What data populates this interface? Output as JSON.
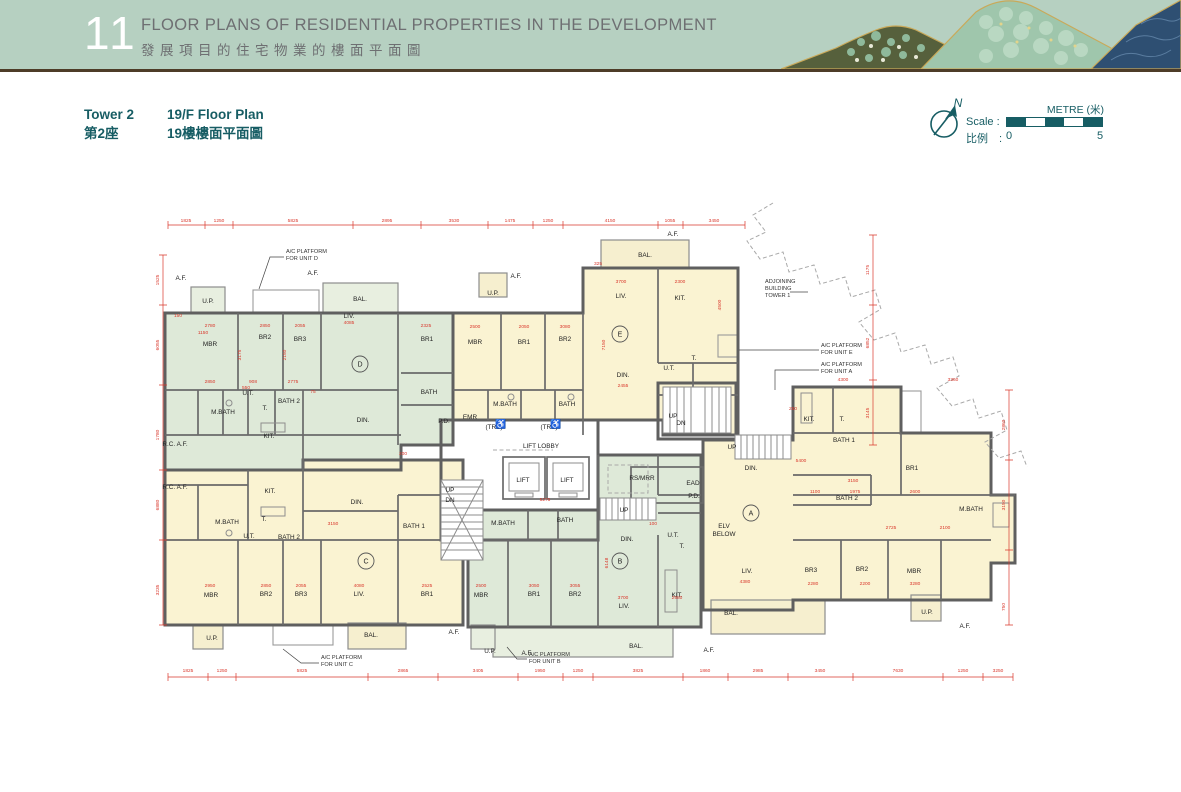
{
  "header": {
    "number": "11",
    "title_en": "FLOOR PLANS OF RESIDENTIAL PROPERTIES IN THE DEVELOPMENT",
    "title_zh": "發展項目的住宅物業的樓面平面圖"
  },
  "subheader": {
    "tower_en": "Tower 2",
    "tower_zh": "第2座",
    "plan_en": "19/F Floor Plan",
    "plan_zh": "19樓樓面平面圖"
  },
  "compass": {
    "north": "N"
  },
  "scale": {
    "label_en": "Scale :",
    "label_zh": "比例　:",
    "metre": "METRE (米)",
    "start": "0",
    "end": "5"
  },
  "colors": {
    "header_green": "#b6d0c1",
    "teal": "#175d64",
    "unit_cream": "#faf3d2",
    "unit_green": "#dee9d8",
    "dimension_red": "#d9372b",
    "wall_grey": "#5f5f5f",
    "rule_brown": "#4d3c28"
  },
  "plan": {
    "unit_circles": [
      {
        "t": "D",
        "x": 207,
        "y": 169
      },
      {
        "t": "E",
        "x": 467,
        "y": 139
      },
      {
        "t": "C",
        "x": 213,
        "y": 366
      },
      {
        "t": "B",
        "x": 467,
        "y": 366
      },
      {
        "t": "A",
        "x": 598,
        "y": 318
      }
    ],
    "rooms": [
      {
        "t": "MBR",
        "x": 57,
        "y": 151
      },
      {
        "t": "BR2",
        "x": 112,
        "y": 144
      },
      {
        "t": "BR3",
        "x": 147,
        "y": 146
      },
      {
        "t": "LIV.",
        "x": 196,
        "y": 123
      },
      {
        "t": "BAL.",
        "x": 207,
        "y": 106
      },
      {
        "t": "U.P.",
        "x": 55,
        "y": 108
      },
      {
        "t": "M.BATH",
        "x": 70,
        "y": 219
      },
      {
        "t": "U.T.",
        "x": 95,
        "y": 200
      },
      {
        "t": "T.",
        "x": 112,
        "y": 215
      },
      {
        "t": "BATH 2",
        "x": 136,
        "y": 208
      },
      {
        "t": "KIT.",
        "x": 116,
        "y": 243
      },
      {
        "t": "DIN.",
        "x": 210,
        "y": 227
      },
      {
        "t": "BR1",
        "x": 274,
        "y": 146
      },
      {
        "t": "BATH",
        "x": 276,
        "y": 199
      },
      {
        "t": "P.D.",
        "x": 291,
        "y": 228
      },
      {
        "t": "MBR",
        "x": 322,
        "y": 149
      },
      {
        "t": "BR1",
        "x": 371,
        "y": 149
      },
      {
        "t": "BR2",
        "x": 412,
        "y": 146
      },
      {
        "t": "LIV.",
        "x": 468,
        "y": 103
      },
      {
        "t": "KIT.",
        "x": 527,
        "y": 105
      },
      {
        "t": "DIN.",
        "x": 470,
        "y": 182
      },
      {
        "t": "BAL.",
        "x": 492,
        "y": 62
      },
      {
        "t": "U.P.",
        "x": 340,
        "y": 100
      },
      {
        "t": "M.BATH",
        "x": 352,
        "y": 211
      },
      {
        "t": "BATH",
        "x": 414,
        "y": 211
      },
      {
        "t": "U.T.",
        "x": 516,
        "y": 175
      },
      {
        "t": "T.",
        "x": 541,
        "y": 165
      },
      {
        "t": "EMR",
        "x": 317,
        "y": 224
      },
      {
        "t": "LIFT LOBBY",
        "x": 388,
        "y": 253
      },
      {
        "t": "LIFT",
        "x": 370,
        "y": 287
      },
      {
        "t": "LIFT",
        "x": 414,
        "y": 287
      },
      {
        "t": "(TRS)",
        "x": 341,
        "y": 234
      },
      {
        "t": "(TRS)",
        "x": 396,
        "y": 234
      },
      {
        "t": "M.BATH",
        "x": 350,
        "y": 330
      },
      {
        "t": "BATH",
        "x": 412,
        "y": 327
      },
      {
        "t": "UP",
        "x": 297,
        "y": 297
      },
      {
        "t": "DN",
        "x": 297,
        "y": 307
      },
      {
        "t": "RS/MRR",
        "x": 489,
        "y": 285
      },
      {
        "t": "EAD",
        "x": 540,
        "y": 290
      },
      {
        "t": "P.D.",
        "x": 541,
        "y": 303
      },
      {
        "t": "UP",
        "x": 471,
        "y": 317
      },
      {
        "t": "ELV",
        "x": 571,
        "y": 333
      },
      {
        "t": "BELOW",
        "x": 571,
        "y": 341
      },
      {
        "t": "UP",
        "x": 520,
        "y": 223
      },
      {
        "t": "DN",
        "x": 528,
        "y": 230
      },
      {
        "t": "DIN.",
        "x": 474,
        "y": 346
      },
      {
        "t": "T.",
        "x": 529,
        "y": 353
      },
      {
        "t": "U.T.",
        "x": 520,
        "y": 342
      },
      {
        "t": "KIT.",
        "x": 524,
        "y": 402
      },
      {
        "t": "LIV.",
        "x": 471,
        "y": 413
      },
      {
        "t": "MBR",
        "x": 328,
        "y": 402
      },
      {
        "t": "BR1",
        "x": 381,
        "y": 401
      },
      {
        "t": "BR2",
        "x": 422,
        "y": 401
      },
      {
        "t": "BAL.",
        "x": 483,
        "y": 453
      },
      {
        "t": "U.P.",
        "x": 337,
        "y": 458
      },
      {
        "t": "KIT.",
        "x": 117,
        "y": 298
      },
      {
        "t": "DIN.",
        "x": 204,
        "y": 309
      },
      {
        "t": "M.BATH",
        "x": 74,
        "y": 329
      },
      {
        "t": "U.T.",
        "x": 96,
        "y": 343
      },
      {
        "t": "T.",
        "x": 111,
        "y": 326
      },
      {
        "t": "BATH 2",
        "x": 136,
        "y": 344
      },
      {
        "t": "BATH 1",
        "x": 261,
        "y": 333
      },
      {
        "t": "MBR",
        "x": 58,
        "y": 402
      },
      {
        "t": "BR2",
        "x": 113,
        "y": 401
      },
      {
        "t": "BR3",
        "x": 148,
        "y": 401
      },
      {
        "t": "LIV.",
        "x": 206,
        "y": 401
      },
      {
        "t": "BR1",
        "x": 274,
        "y": 401
      },
      {
        "t": "BAL.",
        "x": 218,
        "y": 442
      },
      {
        "t": "U.P.",
        "x": 59,
        "y": 445
      },
      {
        "t": "DIN.",
        "x": 598,
        "y": 275
      },
      {
        "t": "LIV.",
        "x": 594,
        "y": 378
      },
      {
        "t": "BAL.",
        "x": 578,
        "y": 420
      },
      {
        "t": "BR3",
        "x": 658,
        "y": 377
      },
      {
        "t": "BR2",
        "x": 709,
        "y": 376
      },
      {
        "t": "MBR",
        "x": 761,
        "y": 378
      },
      {
        "t": "M.BATH",
        "x": 818,
        "y": 316
      },
      {
        "t": "BR1",
        "x": 759,
        "y": 275
      },
      {
        "t": "BATH 1",
        "x": 691,
        "y": 247
      },
      {
        "t": "BATH 2",
        "x": 694,
        "y": 305
      },
      {
        "t": "T.",
        "x": 689,
        "y": 226
      },
      {
        "t": "KIT.",
        "x": 656,
        "y": 226
      },
      {
        "t": "U.P.",
        "x": 774,
        "y": 419
      },
      {
        "t": "UP",
        "x": 579,
        "y": 254
      },
      {
        "t": "A.F.",
        "x": 28,
        "y": 85
      },
      {
        "t": "A.F.",
        "x": 160,
        "y": 80
      },
      {
        "t": "A.F.",
        "x": 363,
        "y": 83
      },
      {
        "t": "A.F.",
        "x": 520,
        "y": 41
      },
      {
        "t": "A.F.",
        "x": 301,
        "y": 439
      },
      {
        "t": "A.F.",
        "x": 374,
        "y": 460
      },
      {
        "t": "A.F.",
        "x": 556,
        "y": 457
      },
      {
        "t": "A.F.",
        "x": 812,
        "y": 433
      },
      {
        "t": "R.C. A.F.",
        "x": 22,
        "y": 251
      },
      {
        "t": "R.C. A.F.",
        "x": 22,
        "y": 294
      }
    ],
    "annotations": [
      {
        "t": "A/C PLATFORM",
        "x": 133,
        "y": 58
      },
      {
        "t": "FOR UNIT D",
        "x": 133,
        "y": 65
      },
      {
        "t": "A/C PLATFORM",
        "x": 668,
        "y": 152
      },
      {
        "t": "FOR UNIT E",
        "x": 668,
        "y": 159
      },
      {
        "t": "A/C PLATFORM",
        "x": 668,
        "y": 171
      },
      {
        "t": "FOR UNIT A",
        "x": 668,
        "y": 178
      },
      {
        "t": "ADJOINING",
        "x": 612,
        "y": 88
      },
      {
        "t": "BUILDING",
        "x": 612,
        "y": 95
      },
      {
        "t": "TOWER 1",
        "x": 612,
        "y": 102
      },
      {
        "t": "A/C PLATFORM",
        "x": 168,
        "y": 464
      },
      {
        "t": "FOR UNIT C",
        "x": 168,
        "y": 471
      },
      {
        "t": "A/C PLATFORM",
        "x": 376,
        "y": 461
      },
      {
        "t": "FOR UNIT B",
        "x": 376,
        "y": 468
      }
    ],
    "icons": [
      {
        "t": "♿",
        "x": 348,
        "y": 232,
        "n": "wheelchair-icon"
      },
      {
        "t": "♿",
        "x": 403,
        "y": 232,
        "n": "wheelchair-icon"
      }
    ],
    "dims": [
      {
        "t": "1825",
        "x": 33,
        "y": 27
      },
      {
        "t": "1250",
        "x": 66,
        "y": 27
      },
      {
        "t": "5825",
        "x": 140,
        "y": 27
      },
      {
        "t": "2895",
        "x": 234,
        "y": 27
      },
      {
        "t": "3530",
        "x": 301,
        "y": 27
      },
      {
        "t": "1475",
        "x": 357,
        "y": 27
      },
      {
        "t": "1250",
        "x": 395,
        "y": 27
      },
      {
        "t": "4150",
        "x": 457,
        "y": 27
      },
      {
        "t": "1055",
        "x": 517,
        "y": 27
      },
      {
        "t": "3450",
        "x": 561,
        "y": 27
      },
      {
        "t": "1825",
        "x": 35,
        "y": 477
      },
      {
        "t": "1250",
        "x": 69,
        "y": 477
      },
      {
        "t": "5825",
        "x": 149,
        "y": 477
      },
      {
        "t": "2865",
        "x": 250,
        "y": 477
      },
      {
        "t": "3405",
        "x": 325,
        "y": 477
      },
      {
        "t": "1950",
        "x": 387,
        "y": 477
      },
      {
        "t": "1250",
        "x": 425,
        "y": 477
      },
      {
        "t": "3825",
        "x": 485,
        "y": 477
      },
      {
        "t": "1860",
        "x": 552,
        "y": 477
      },
      {
        "t": "2985",
        "x": 605,
        "y": 477
      },
      {
        "t": "3450",
        "x": 667,
        "y": 477
      },
      {
        "t": "7630",
        "x": 745,
        "y": 477
      },
      {
        "t": "1250",
        "x": 810,
        "y": 477
      },
      {
        "t": "3250",
        "x": 845,
        "y": 477
      },
      {
        "t": "1525",
        "x": 6,
        "y": 85,
        "r": -90
      },
      {
        "t": "6055",
        "x": 6,
        "y": 150,
        "r": -90
      },
      {
        "t": "1780",
        "x": 6,
        "y": 240,
        "r": -90
      },
      {
        "t": "6880",
        "x": 6,
        "y": 310,
        "r": -90
      },
      {
        "t": "3235",
        "x": 6,
        "y": 395,
        "r": -90
      },
      {
        "t": "1175",
        "x": 716,
        "y": 75,
        "r": -90
      },
      {
        "t": "6852",
        "x": 716,
        "y": 148,
        "r": -90
      },
      {
        "t": "3145",
        "x": 716,
        "y": 218,
        "r": -90
      },
      {
        "t": "2860",
        "x": 852,
        "y": 230,
        "r": -90
      },
      {
        "t": "3150",
        "x": 852,
        "y": 310,
        "r": -90
      },
      {
        "t": "750",
        "x": 852,
        "y": 412,
        "r": -90
      },
      {
        "t": "2780",
        "x": 57,
        "y": 132
      },
      {
        "t": "1150",
        "x": 50,
        "y": 139
      },
      {
        "t": "2850",
        "x": 112,
        "y": 132
      },
      {
        "t": "2055",
        "x": 147,
        "y": 132
      },
      {
        "t": "4085",
        "x": 196,
        "y": 129
      },
      {
        "t": "2325",
        "x": 273,
        "y": 132
      },
      {
        "t": "2850",
        "x": 57,
        "y": 188
      },
      {
        "t": "908",
        "x": 100,
        "y": 188
      },
      {
        "t": "2775",
        "x": 140,
        "y": 188
      },
      {
        "t": "550",
        "x": 93,
        "y": 194
      },
      {
        "t": "3175",
        "x": 88,
        "y": 160,
        "r": -90
      },
      {
        "t": "2150",
        "x": 133,
        "y": 160,
        "r": -90
      },
      {
        "t": "2500",
        "x": 322,
        "y": 133
      },
      {
        "t": "2050",
        "x": 371,
        "y": 133
      },
      {
        "t": "3080",
        "x": 412,
        "y": 133
      },
      {
        "t": "3700",
        "x": 468,
        "y": 88
      },
      {
        "t": "2300",
        "x": 527,
        "y": 88
      },
      {
        "t": "7150",
        "x": 452,
        "y": 150,
        "r": -90
      },
      {
        "t": "2455",
        "x": 470,
        "y": 192
      },
      {
        "t": "4500",
        "x": 568,
        "y": 110,
        "r": -90
      },
      {
        "t": "5275",
        "x": 392,
        "y": 306
      },
      {
        "t": "2500",
        "x": 328,
        "y": 392
      },
      {
        "t": "3050",
        "x": 381,
        "y": 392
      },
      {
        "t": "3055",
        "x": 422,
        "y": 392
      },
      {
        "t": "3700",
        "x": 470,
        "y": 404
      },
      {
        "t": "2980",
        "x": 524,
        "y": 404
      },
      {
        "t": "6148",
        "x": 455,
        "y": 368,
        "r": -90
      },
      {
        "t": "2950",
        "x": 57,
        "y": 392
      },
      {
        "t": "2850",
        "x": 113,
        "y": 392
      },
      {
        "t": "2055",
        "x": 148,
        "y": 392
      },
      {
        "t": "4080",
        "x": 206,
        "y": 392
      },
      {
        "t": "2525",
        "x": 274,
        "y": 392
      },
      {
        "t": "3150",
        "x": 180,
        "y": 330
      },
      {
        "t": "5400",
        "x": 648,
        "y": 267
      },
      {
        "t": "3150",
        "x": 700,
        "y": 287
      },
      {
        "t": "1100",
        "x": 662,
        "y": 298
      },
      {
        "t": "1975",
        "x": 702,
        "y": 298
      },
      {
        "t": "2600",
        "x": 762,
        "y": 298
      },
      {
        "t": "2725",
        "x": 738,
        "y": 334
      },
      {
        "t": "2100",
        "x": 792,
        "y": 334
      },
      {
        "t": "3280",
        "x": 762,
        "y": 390
      },
      {
        "t": "2200",
        "x": 712,
        "y": 390
      },
      {
        "t": "2280",
        "x": 660,
        "y": 390
      },
      {
        "t": "4300",
        "x": 690,
        "y": 186
      },
      {
        "t": "3360",
        "x": 800,
        "y": 186
      },
      {
        "t": "4380",
        "x": 592,
        "y": 388
      },
      {
        "t": "150",
        "x": 25,
        "y": 122
      },
      {
        "t": "75",
        "x": 160,
        "y": 198
      },
      {
        "t": "200",
        "x": 250,
        "y": 260
      },
      {
        "t": "325",
        "x": 445,
        "y": 70
      },
      {
        "t": "100",
        "x": 500,
        "y": 330
      },
      {
        "t": "250",
        "x": 640,
        "y": 215
      }
    ]
  }
}
